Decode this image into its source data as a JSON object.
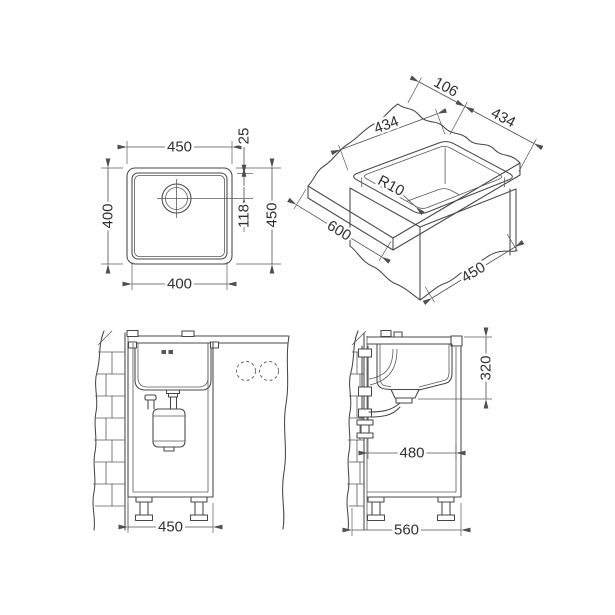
{
  "drawing": {
    "accent_line_color": "#474747",
    "views": {
      "top_view": {
        "outer_width": "450",
        "bowl_height": "400",
        "bowl_width": "400",
        "rim_offset": "25",
        "drain_offset": "118",
        "outer_depth": "450"
      },
      "iso_view": {
        "back_clearance": "106",
        "cutout_side_left": "434",
        "cutout_side_right": "434",
        "corner_radius": "R10",
        "counter_width": "600",
        "counter_depth": "450"
      },
      "front_view": {
        "cabinet_width": "450"
      },
      "side_view": {
        "drain_height": "320",
        "clearance_width": "480",
        "cabinet_depth": "560"
      }
    }
  }
}
